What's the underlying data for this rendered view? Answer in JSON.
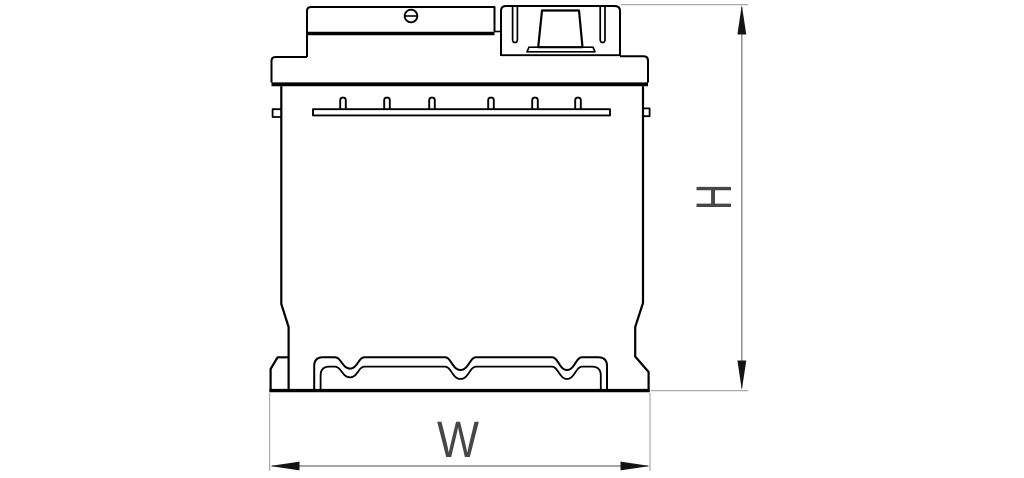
{
  "labels": {
    "height": "H",
    "width": "W"
  },
  "colors": {
    "outline": "#000000",
    "extension_line": "#ababab",
    "dimension_line": "#8a8a8a",
    "arrow": "#141414",
    "label": "#474747",
    "background": "#ffffff"
  }
}
